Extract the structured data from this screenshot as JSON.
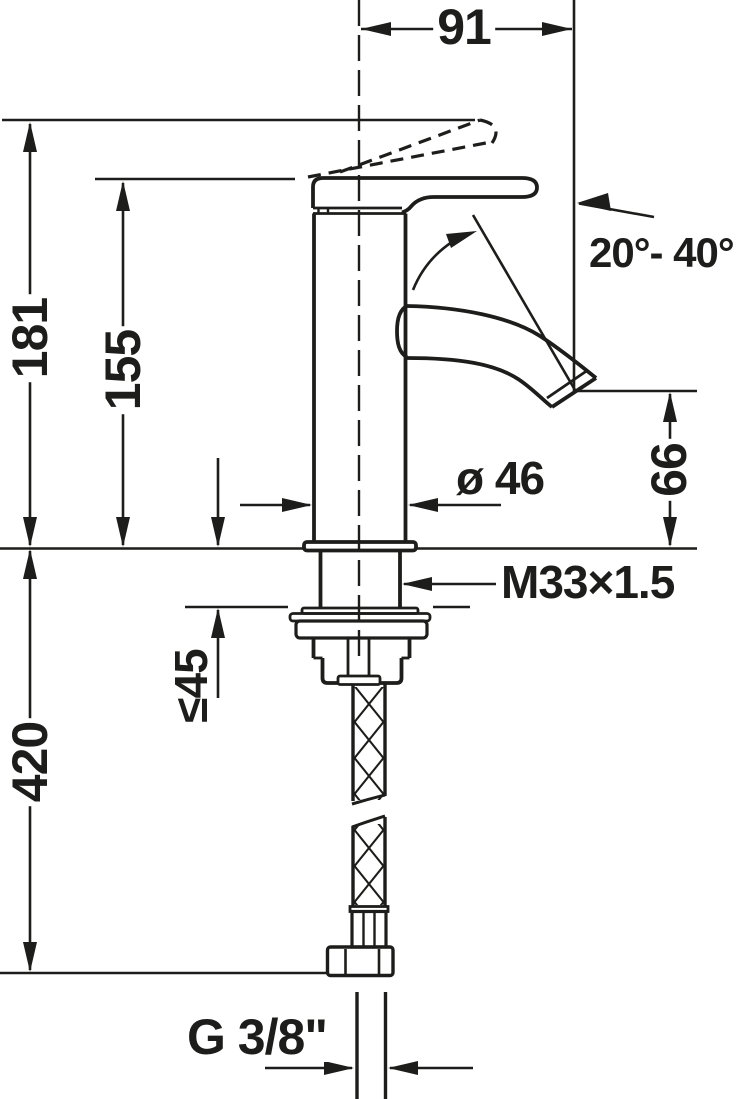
{
  "colors": {
    "line": "#1d1d1b",
    "background": "#ffffff"
  },
  "dimensions": {
    "top_width": "91",
    "total_height": "181",
    "lever_height": "155",
    "lever_angle_range": "20°- 40°",
    "spout_outlet_height": "66",
    "body_diameter": "ø 46",
    "shank_thread": "M33×1.5",
    "max_mounting_thickness": "≤45",
    "hose_length": "420",
    "supply_connection": "G 3/8\""
  }
}
